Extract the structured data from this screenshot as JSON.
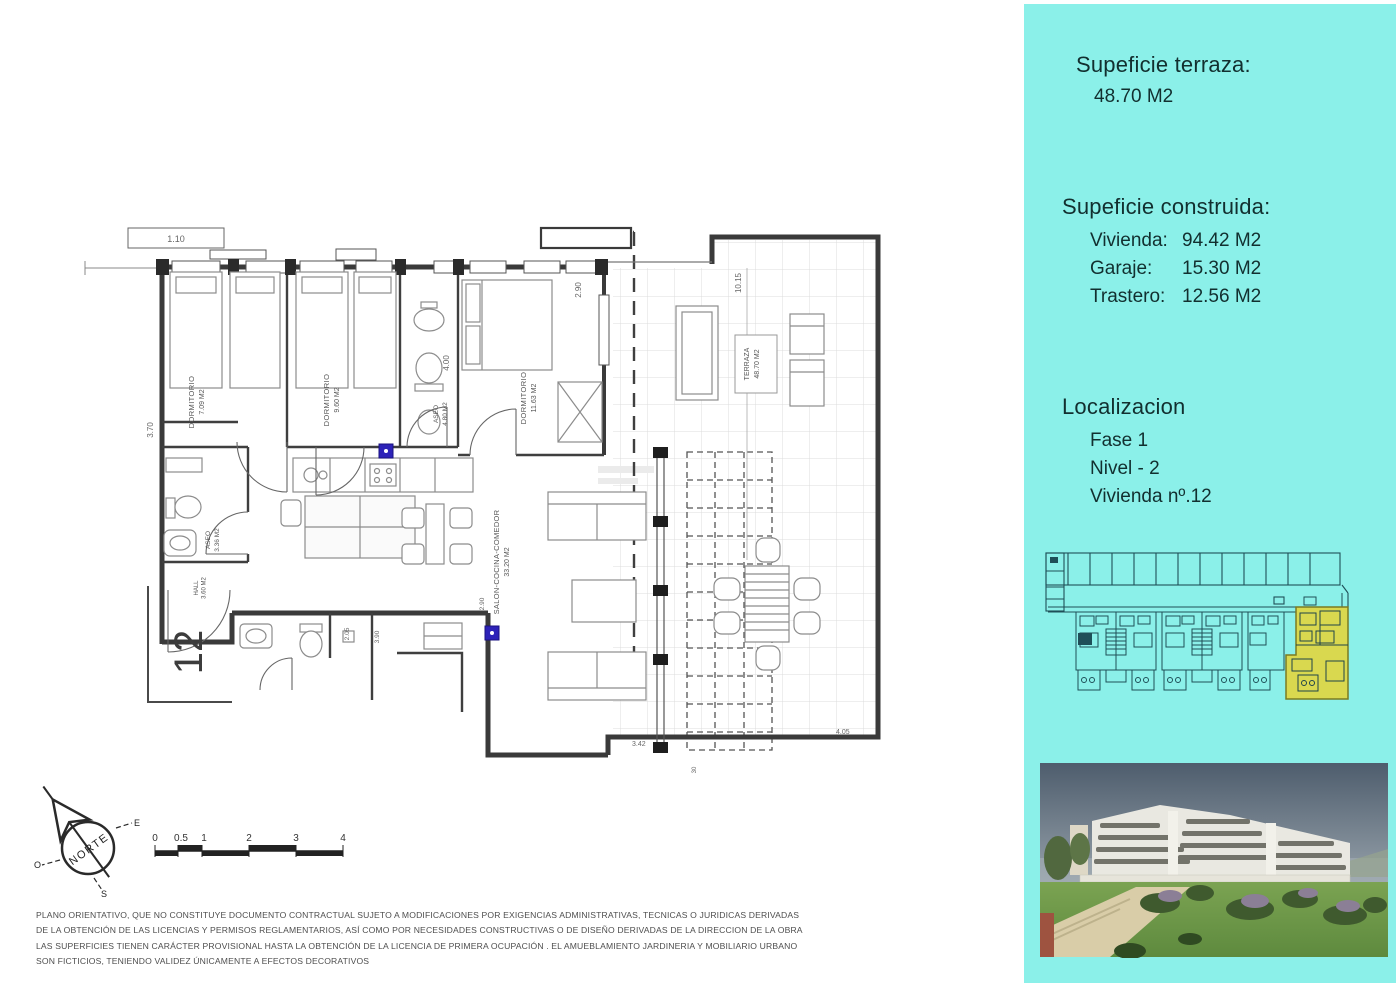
{
  "panel": {
    "terrace": {
      "title": "Supeficie terraza:",
      "value": "48.70 M2"
    },
    "built": {
      "title": "Supeficie construida:",
      "items": [
        {
          "label": "Vivienda:",
          "value": "94.42 M2"
        },
        {
          "label": "Garaje:",
          "value": "15.30 M2"
        },
        {
          "label": "Trastero:",
          "value": "12.56 M2"
        }
      ]
    },
    "location": {
      "title": "Localizacion",
      "items": [
        "Fase 1",
        "Nivel - 2",
        "Vivienda nº.12"
      ]
    }
  },
  "plan": {
    "rooms": {
      "d1": {
        "name": "DORMITORIO",
        "area": "7.09 M2"
      },
      "d2": {
        "name": "DORMITORIO",
        "area": "9.60 M2"
      },
      "d3": {
        "name": "DORMITORIO",
        "area": "11.63 M2"
      },
      "bath": {
        "name": "ASEO",
        "area": "4.80 M2"
      },
      "wc": {
        "name": "ASEO",
        "area": "3.36 M2"
      },
      "hall": {
        "name": "HALL",
        "area": "3.60 M2"
      },
      "salon": {
        "name": "SALON-COCINA-COMEDOR",
        "area": "33.20 M2"
      },
      "terrace": {
        "name": "TERRAZA",
        "area": "48.70 M2"
      }
    },
    "unit_number": "12",
    "dims": {
      "top_left": "1.10",
      "left": "3.70",
      "bath": "4.00",
      "master": "2.90",
      "terrace_height": "10.15",
      "strip_a": "2.05",
      "strip_b": "3.90",
      "living_door": "2.90",
      "bottom_right": "3.42",
      "terrace_bottom": "4.05",
      "tiny": "30"
    },
    "compass": {
      "north": "NORTE",
      "east": "E",
      "south": "S",
      "west": "O"
    },
    "scale_ticks": [
      "0",
      "0.5",
      "1",
      "2",
      "3",
      "4"
    ]
  },
  "disclaimer": {
    "lines": [
      "PLANO ORIENTATIVO, QUE NO CONSTITUYE DOCUMENTO CONTRACTUAL SUJETO A MODIFICACIONES POR EXIGENCIAS ADMINISTRATIVAS, TECNICAS O JURIDICAS DERIVADAS",
      "DE LA OBTENCIÓN DE LAS LICENCIAS Y PERMISOS REGLAMENTARIOS, ASÍ COMO POR NECESIDADES CONSTRUCTIVAS  O DE DISEÑO DERIVADAS DE LA DIRECCION DE LA OBRA",
      "LAS SUPERFICIES TIENEN CARÁCTER PROVISIONAL HASTA LA OBTENCIÓN DE LA LICENCIA DE PRIMERA OCUPACIÓN . EL AMUEBLAMIENTO JARDINERIA Y MOBILIARIO URBANO",
      "SON FICTICIOS, TENIENDO VALIDEZ ÚNICAMENTE  A EFECTOS DECORATIVOS"
    ]
  },
  "colors": {
    "panel_bg": "#8bf0e9",
    "unit_highlight": "#d9d84f",
    "marker_blue": "#2d22b8",
    "plan_line": "#3a3a3a"
  }
}
